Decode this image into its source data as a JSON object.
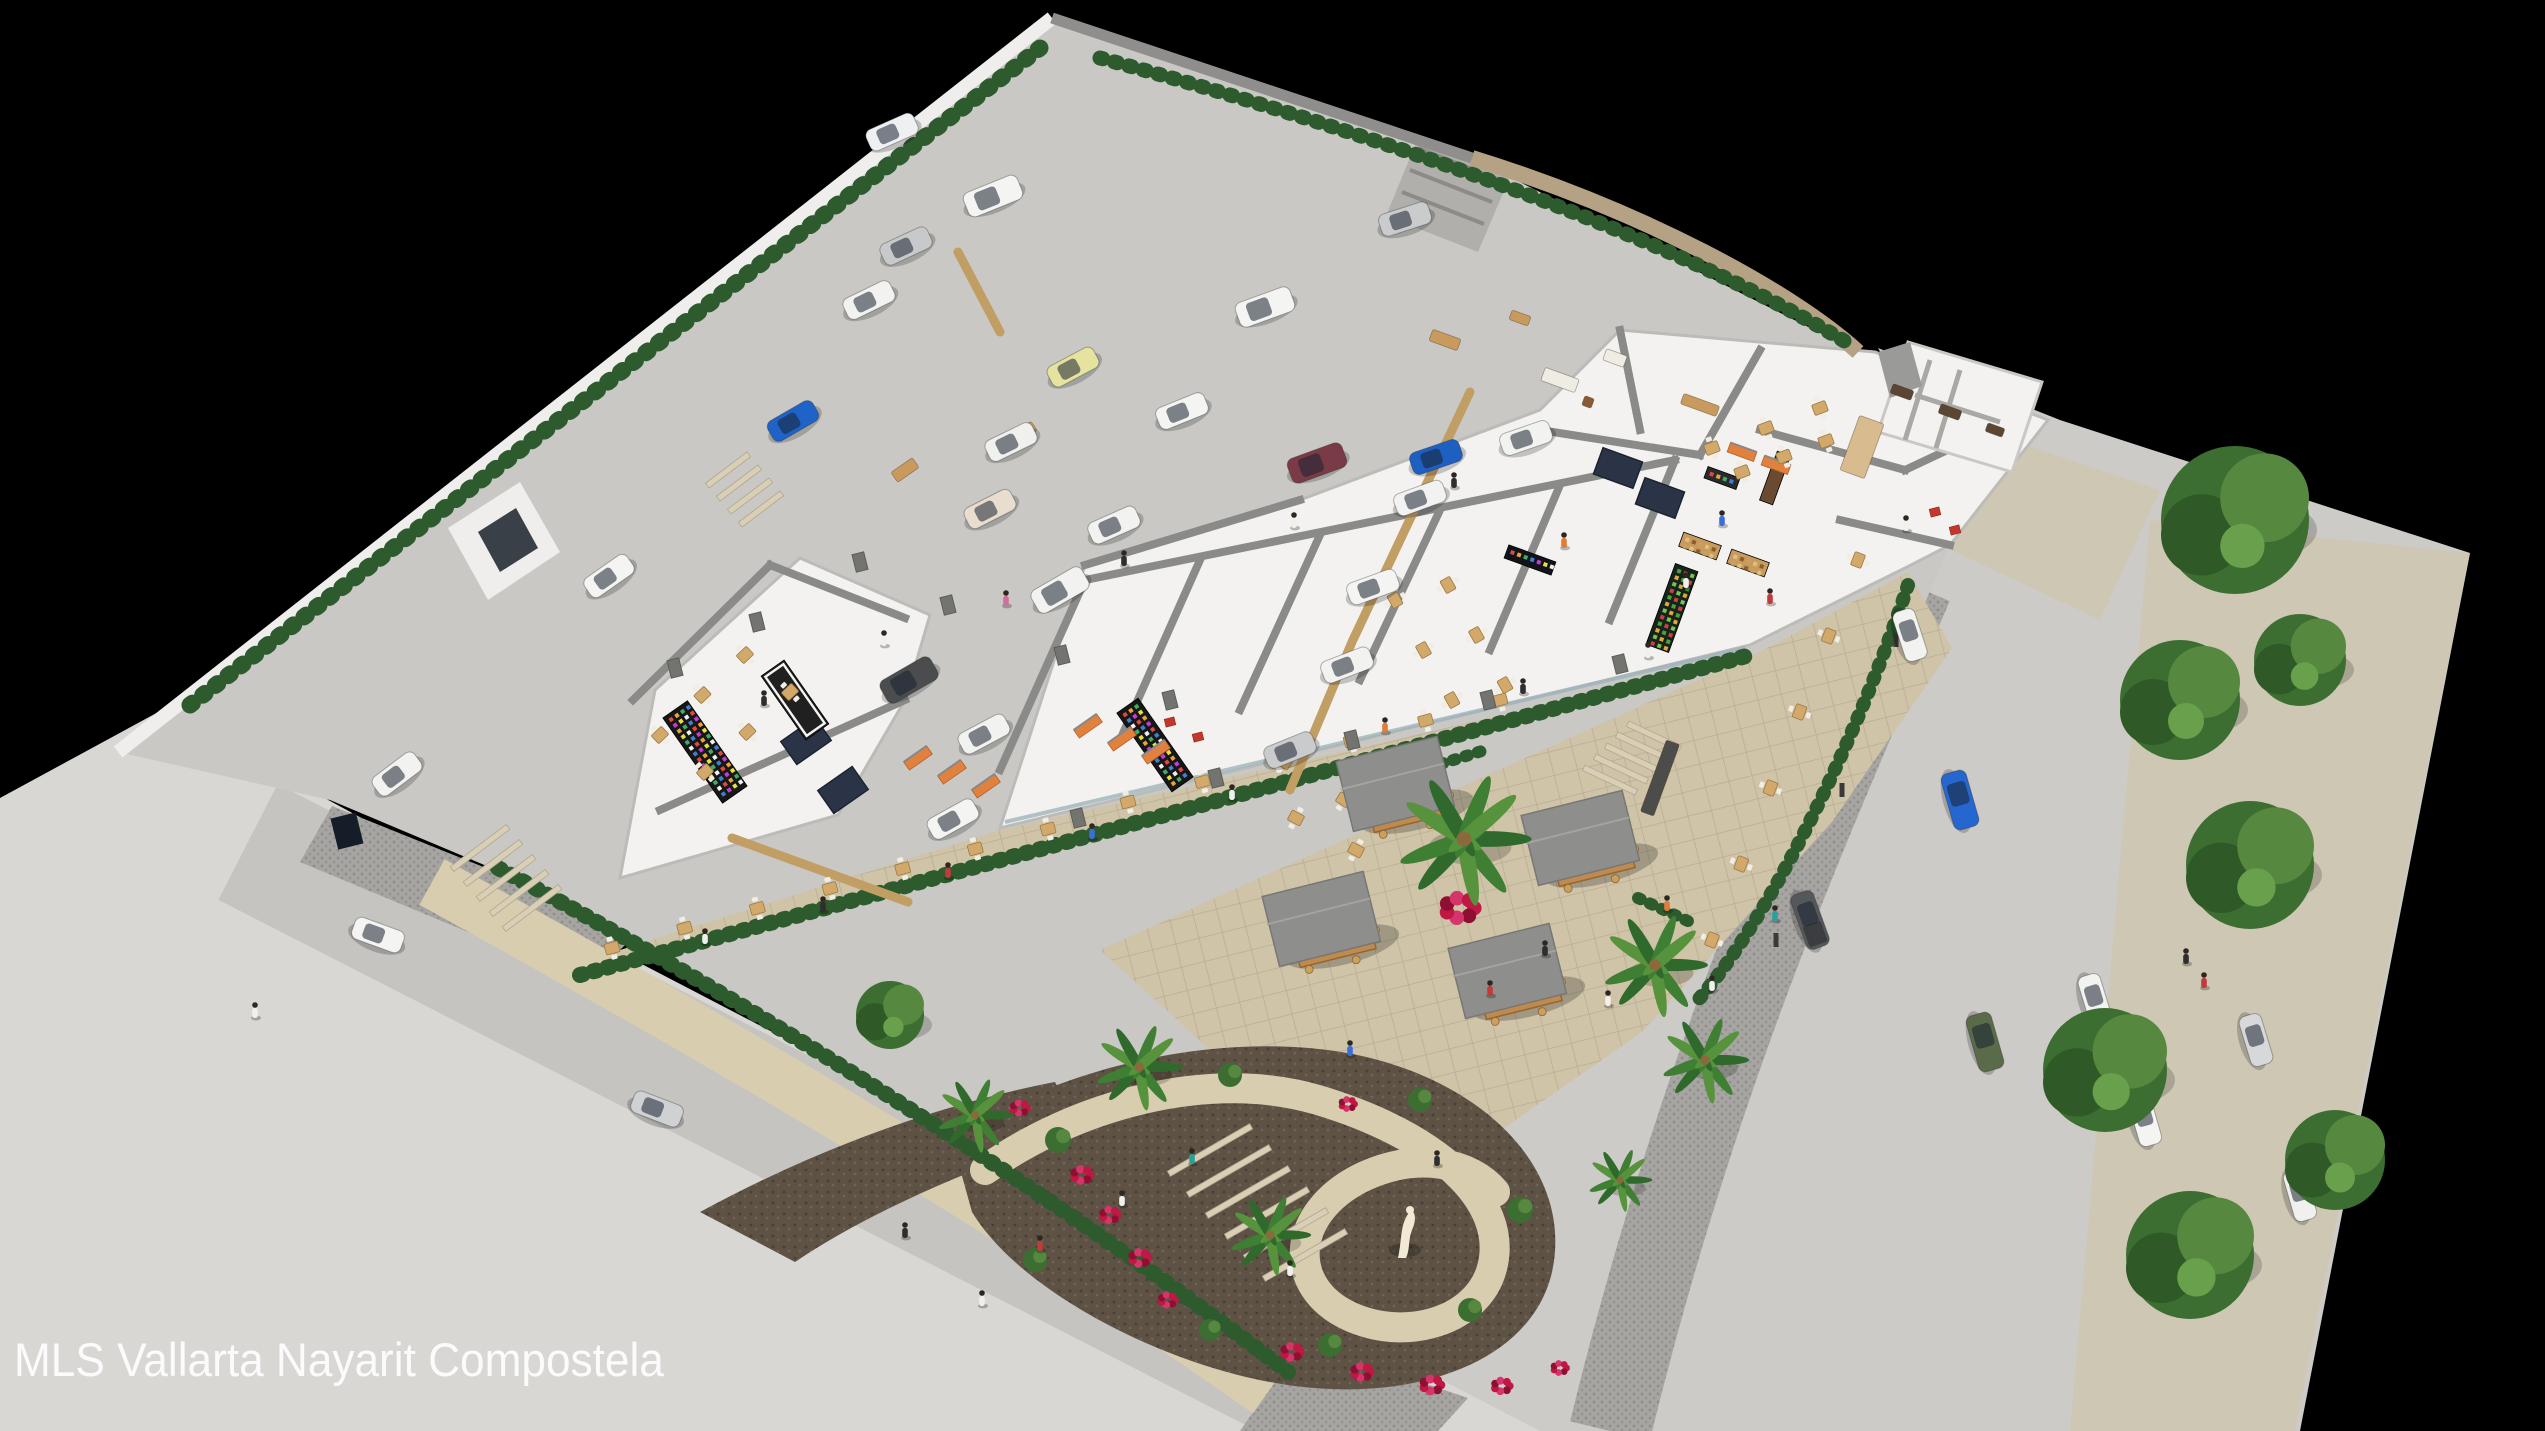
{
  "caption": "MLS Vallarta Nayarit Compostela",
  "scene": {
    "title": "aerial-3d-render-commercial-plaza",
    "colors": {
      "background": "#000000",
      "street": "#c6c4c1",
      "street_right": "#cdcbc8",
      "sidewalk": "#d9d7d4",
      "sidewalk_right": "#cec7b4",
      "cobble": "#a7a5a2",
      "cobble_dot": "#8f8d8a",
      "parking": "#c9c8c5",
      "building_floor": "#f3f2f0",
      "building_wall": "#8a8a88",
      "building_outline": "#bcbbb8",
      "wall_white": "#efeeec",
      "wall_gray": "#8f8e8c",
      "wall_tan": "#b5a184",
      "hedge": "#2d5b2d",
      "tree": "#3c6e31",
      "tree_light": "#57883f",
      "tree_dark": "#2f5a27",
      "palm": "#2f6a2c",
      "mulch": "#5e5244",
      "path": "#d9cdb0",
      "plaza": "#cfc3a8",
      "plaza_line": "#b8ad94",
      "flowers": "#c01744",
      "kiosk_roof": "#8e8e8c",
      "kiosk_wood": "#c08a4e",
      "table_wood": "#d2a96b",
      "divider": "#c19e63",
      "skylight": "#2a3446",
      "pillar": "#73736f",
      "statue": "#f2e9d4"
    }
  },
  "cars": [
    [
      892,
      132,
      -24,
      "#eef0f2",
      "s"
    ],
    [
      906,
      246,
      -25,
      "#c7c9cb",
      "s"
    ],
    [
      869,
      300,
      -26,
      "#f2f2f0",
      "s"
    ],
    [
      993,
      196,
      -22,
      "#f4f4f2",
      "u"
    ],
    [
      1073,
      367,
      -28,
      "#e6e2a0",
      "s"
    ],
    [
      1011,
      442,
      -26,
      "#f0f0ee",
      "s"
    ],
    [
      990,
      509,
      -27,
      "#e9ddd0",
      "s"
    ],
    [
      1114,
      525,
      -24,
      "#f2f2f0",
      "s"
    ],
    [
      1182,
      411,
      -22,
      "#f4f4f2",
      "s"
    ],
    [
      793,
      421,
      -30,
      "#1f63c8",
      "s"
    ],
    [
      1317,
      463,
      -20,
      "#7a3b47",
      "u"
    ],
    [
      1436,
      457,
      -19,
      "#1e5fc2",
      "s"
    ],
    [
      1420,
      498,
      -20,
      "#f2f2f0",
      "s"
    ],
    [
      1373,
      587,
      -20,
      "#f4f4f2",
      "s"
    ],
    [
      1347,
      665,
      -21,
      "#f2f2f0",
      "s"
    ],
    [
      1290,
      750,
      -22,
      "#c9cbcd",
      "s"
    ],
    [
      909,
      680,
      -30,
      "#4a4c4e",
      "u"
    ],
    [
      984,
      734,
      -28,
      "#f2f2f0",
      "s"
    ],
    [
      953,
      819,
      -29,
      "#f4f4f2",
      "s"
    ],
    [
      1405,
      219,
      -18,
      "#c9cbcd",
      "s"
    ],
    [
      1265,
      307,
      -20,
      "#f4f4f2",
      "u"
    ],
    [
      1526,
      438,
      -19,
      "#f2f2f0",
      "s"
    ],
    [
      1060,
      590,
      -30,
      "#f2f2f0",
      "u"
    ],
    [
      609,
      576,
      -35,
      "#f4f4f2",
      "s"
    ],
    [
      397,
      774,
      -37,
      "#f2f2f0",
      "s"
    ],
    [
      378,
      935,
      20,
      "#f4f4f2",
      "s"
    ],
    [
      657,
      1109,
      21,
      "#cfd1d3",
      "s"
    ],
    [
      1910,
      635,
      72,
      "#f2f2f0",
      "s"
    ],
    [
      1960,
      800,
      74,
      "#2566cf",
      "u"
    ],
    [
      1810,
      920,
      70,
      "#54575b",
      "p"
    ],
    [
      1985,
      1042,
      74,
      "#5a6b4a",
      "u"
    ],
    [
      2095,
      1000,
      73,
      "#f2f2f0",
      "s"
    ],
    [
      2145,
      1120,
      74,
      "#f4f4f2",
      "s"
    ],
    [
      2183,
      690,
      72,
      "#e8e8e6",
      "s"
    ],
    [
      2256,
      1040,
      73,
      "#d7d8da",
      "s"
    ],
    [
      2300,
      1195,
      74,
      "#f0f0ee",
      "s"
    ],
    [
      2215,
      487,
      70,
      "#eef0f0",
      "s"
    ]
  ],
  "trees": [
    [
      2235,
      520,
      74
    ],
    [
      2180,
      700,
      60
    ],
    [
      2250,
      865,
      64
    ],
    [
      2105,
      1070,
      62
    ],
    [
      2190,
      1255,
      64
    ],
    [
      2335,
      1160,
      50
    ],
    [
      2300,
      660,
      46
    ],
    [
      890,
      1015,
      34
    ]
  ],
  "palms": [
    [
      1464,
      839,
      46
    ],
    [
      1655,
      965,
      36
    ],
    [
      1705,
      1060,
      30
    ],
    [
      1139,
      1067,
      30
    ],
    [
      1270,
      1235,
      28
    ],
    [
      975,
      1115,
      26
    ],
    [
      1620,
      1180,
      22
    ]
  ],
  "kiosks": [
    [
      1405,
      798
    ],
    [
      1590,
      852
    ],
    [
      1331,
      933
    ],
    [
      1517,
      985
    ]
  ],
  "tables_rows": [
    [
      612,
      948,
      1048,
      829,
      7
    ],
    [
      1128,
      802,
      1500,
      700,
      6
    ],
    [
      1858,
      560,
      1712,
      940,
      6
    ],
    [
      1284,
      762,
      1344,
      800,
      2
    ],
    [
      1296,
      818,
      1356,
      850,
      2
    ],
    [
      660,
      735,
      745,
      655,
      3
    ],
    [
      705,
      772,
      790,
      692,
      3
    ],
    [
      1395,
      600,
      1452,
      700,
      3
    ],
    [
      1448,
      585,
      1505,
      685,
      3
    ],
    [
      1712,
      448,
      1820,
      408,
      3
    ],
    [
      1742,
      472,
      1826,
      441,
      3
    ]
  ],
  "people": [
    [
      705,
      938,
      "#f2f0ec"
    ],
    [
      823,
      906,
      "#2e2e2e"
    ],
    [
      948,
      872,
      "#c23b3b"
    ],
    [
      1092,
      833,
      "#3a6fd8"
    ],
    [
      1232,
      794,
      "#f2f0ec"
    ],
    [
      1385,
      727,
      "#e07b39"
    ],
    [
      1523,
      688,
      "#2e2e2e"
    ],
    [
      1648,
      652,
      "#f2f0ec"
    ],
    [
      1545,
      950,
      "#2e2e2e"
    ],
    [
      1490,
      990,
      "#c23b3b"
    ],
    [
      1608,
      1000,
      "#f2f0ec"
    ],
    [
      1350,
      1050,
      "#3a6fd8"
    ],
    [
      1437,
      1160,
      "#2e2e2e"
    ],
    [
      1667,
      905,
      "#e07b39"
    ],
    [
      1712,
      985,
      "#f2f0ec"
    ],
    [
      1775,
      915,
      "#2aa198"
    ],
    [
      1122,
      1200,
      "#f2f0ec"
    ],
    [
      1040,
      1245,
      "#c23b3b"
    ],
    [
      1290,
      1270,
      "#f2f0ec"
    ],
    [
      1192,
      1158,
      "#2aa198"
    ],
    [
      905,
      1232,
      "#2e2e2e"
    ],
    [
      982,
      1300,
      "#f2f0ec"
    ],
    [
      255,
      1012,
      "#f2f0ec"
    ],
    [
      1906,
      525,
      "#f2f0ec"
    ],
    [
      2186,
      958,
      "#2e2e2e"
    ],
    [
      2204,
      982,
      "#c23b3b"
    ],
    [
      764,
      700,
      "#2e2e2e"
    ],
    [
      884,
      640,
      "#f2f0ec"
    ],
    [
      1006,
      600,
      "#d06f9c"
    ],
    [
      1124,
      560,
      "#2e2e2e"
    ],
    [
      1294,
      522,
      "#f2f0ec"
    ],
    [
      1454,
      482,
      "#2e2e2e"
    ],
    [
      1564,
      542,
      "#e07b39"
    ],
    [
      1686,
      582,
      "#f2f0ec"
    ],
    [
      1770,
      598,
      "#c23b3b"
    ],
    [
      1722,
      520,
      "#3a6fd8"
    ]
  ],
  "flowers": [
    [
      1460,
      908,
      26
    ],
    [
      1082,
      1175,
      15
    ],
    [
      1110,
      1215,
      14
    ],
    [
      1140,
      1258,
      15
    ],
    [
      1168,
      1300,
      13
    ],
    [
      1348,
      1104,
      12
    ],
    [
      1292,
      1352,
      15
    ],
    [
      1362,
      1372,
      15
    ],
    [
      1432,
      1385,
      16
    ],
    [
      1502,
      1386,
      14
    ],
    [
      1560,
      1368,
      12
    ],
    [
      1020,
      1108,
      13
    ]
  ],
  "greens": [
    [
      1058,
      1140,
      13
    ],
    [
      1230,
      1075,
      12
    ],
    [
      1420,
      1100,
      12
    ],
    [
      1520,
      1210,
      13
    ],
    [
      1470,
      1310,
      12
    ],
    [
      1330,
      1345,
      12
    ],
    [
      1035,
      1260,
      12
    ],
    [
      1210,
      1330,
      11
    ]
  ],
  "pillars": [
    [
      948,
      605
    ],
    [
      1062,
      655
    ],
    [
      1170,
      700
    ],
    [
      860,
      562
    ],
    [
      757,
      622
    ],
    [
      675,
      668
    ],
    [
      1078,
      818
    ],
    [
      1216,
      778
    ],
    [
      1352,
      740
    ],
    [
      1488,
      700
    ],
    [
      1620,
      664
    ]
  ],
  "bollards": [
    [
      1896,
      640
    ],
    [
      1842,
      790
    ],
    [
      1776,
      940
    ]
  ],
  "skylights": [
    [
      806,
      741,
      -35
    ],
    [
      843,
      790,
      -35
    ],
    [
      1618,
      468,
      20
    ],
    [
      1660,
      498,
      20
    ]
  ],
  "displays": [
    [
      705,
      752,
      -35,
      30,
      104,
      "#171717",
      "rainbow"
    ],
    [
      1155,
      745,
      -35,
      26,
      96,
      "#171717",
      "rainbow"
    ],
    [
      795,
      700,
      -35,
      28,
      78,
      "#202020",
      "frame"
    ],
    [
      1672,
      608,
      20,
      24,
      86,
      "#14251b",
      "produce"
    ],
    [
      1700,
      546,
      20,
      40,
      15,
      "#c89a5e",
      "goods"
    ],
    [
      1748,
      563,
      20,
      40,
      15,
      "#c89a5e",
      "goods"
    ],
    [
      1722,
      478,
      20,
      34,
      12,
      "#2a2a2a",
      "rainbow"
    ],
    [
      1775,
      478,
      20,
      14,
      52,
      "#6a4a30",
      "plain"
    ],
    [
      1530,
      560,
      20,
      50,
      14,
      "#10141a",
      "rainbow"
    ]
  ],
  "racks": [
    [
      918,
      758,
      -35
    ],
    [
      952,
      772,
      -35
    ],
    [
      986,
      786,
      -35
    ],
    [
      1088,
      726,
      -35
    ],
    [
      1122,
      739,
      -35
    ],
    [
      1156,
      752,
      -35
    ],
    [
      1742,
      452,
      20
    ],
    [
      1776,
      465,
      20
    ]
  ],
  "furniture": [
    [
      1560,
      380,
      36,
      14,
      "#efece4",
      20
    ],
    [
      1615,
      358,
      22,
      12,
      "#efece4",
      20
    ],
    [
      1588,
      402,
      10,
      10,
      "#8a5a36",
      20
    ],
    [
      1700,
      405,
      38,
      11,
      "#c89a5e",
      20
    ],
    [
      1862,
      447,
      26,
      58,
      "#d9bb90",
      20
    ],
    [
      1902,
      392,
      22,
      10,
      "#5a4632",
      20
    ],
    [
      1950,
      412,
      22,
      10,
      "#5a4632",
      20
    ],
    [
      1995,
      430,
      18,
      9,
      "#5a4632",
      20
    ],
    [
      905,
      470,
      26,
      12,
      "#c89a5e",
      -35
    ],
    [
      1025,
      432,
      22,
      11,
      "#c89a5e",
      -35
    ],
    [
      1445,
      340,
      30,
      12,
      "#c89a5e",
      20
    ],
    [
      1520,
      318,
      20,
      10,
      "#c89a5e",
      20
    ],
    [
      1660,
      778,
      14,
      76,
      "#4c4c4a",
      20
    ]
  ],
  "stairs": [
    [
      480,
      848,
      -37,
      70,
      5,
      13,
      15
    ],
    [
      1210,
      1150,
      -30,
      95,
      6,
      19,
      21
    ],
    [
      1610,
      780,
      25,
      58,
      5,
      11,
      -11
    ],
    [
      728,
      470,
      -37,
      52,
      4,
      11,
      13
    ]
  ],
  "dividers": [
    [
      [
        958,
        252
      ],
      [
        1000,
        332
      ]
    ],
    [
      [
        732,
        838
      ],
      [
        908,
        902
      ]
    ],
    [
      [
        1470,
        392
      ],
      [
        1352,
        642
      ],
      [
        1290,
        790
      ]
    ]
  ],
  "red_flags": [
    [
      1170,
      722
    ],
    [
      1198,
      737
    ],
    [
      1935,
      512
    ],
    [
      1955,
      530
    ]
  ]
}
